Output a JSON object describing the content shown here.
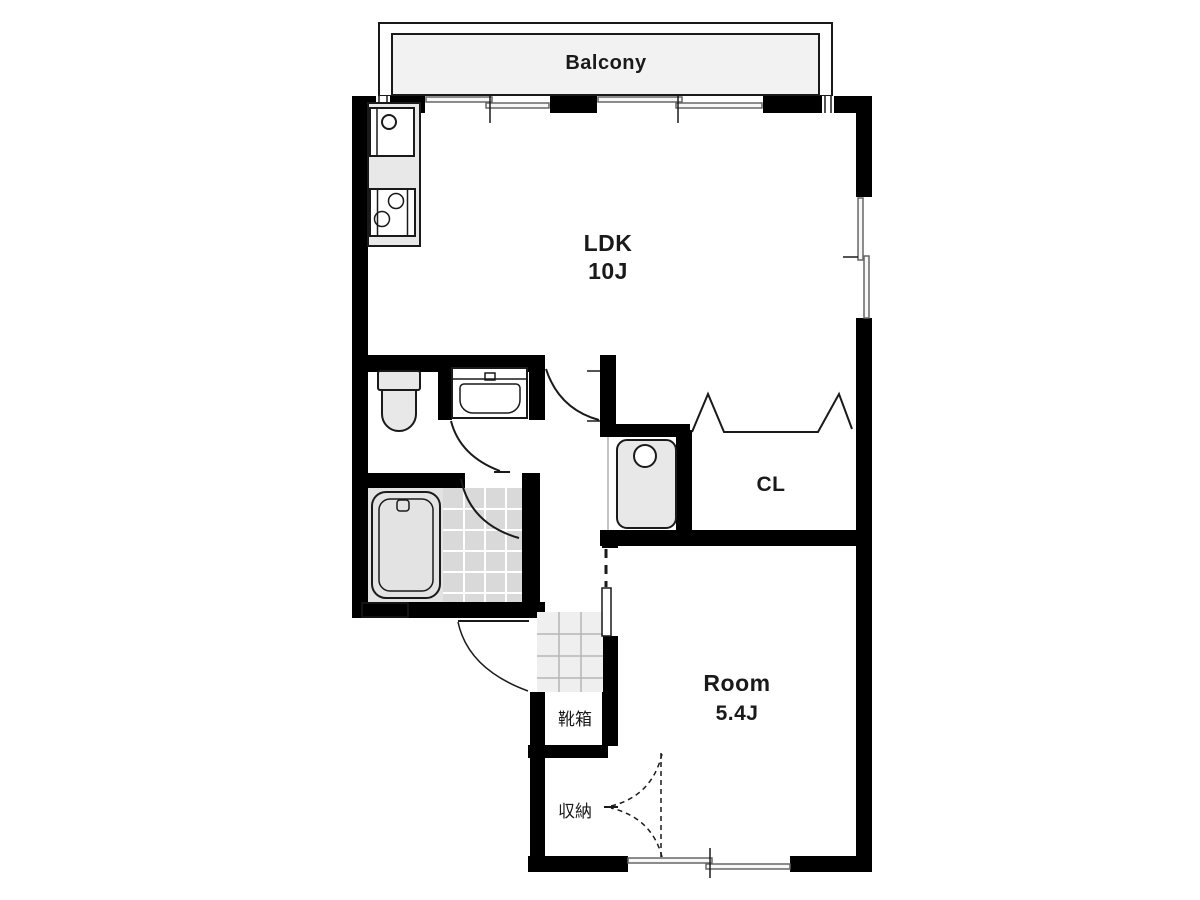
{
  "plan": {
    "labels": {
      "balcony": "Balcony",
      "ldk": "LDK",
      "ldk_size": "10J",
      "closet": "CL",
      "room": "Room",
      "room_size": "5.4J",
      "shoe_cabinet": "靴箱",
      "storage": "収納"
    },
    "fixtures": [
      "kitchen-sink",
      "gas-stove",
      "toilet",
      "washbasin-vanity",
      "bathtub",
      "washing-machine-pan",
      "shoe-cabinet",
      "storage-closet"
    ],
    "colors": {
      "wall": "#000000",
      "line": "#1a1a1a",
      "fixture_fill": "#e8e8e8",
      "bathroom_floor": "#e3e3e3",
      "tile_fill": "#d9d9d9",
      "genkan_tile_fill": "#efefef",
      "balcony_fill": "#f2f2f2",
      "background": "#ffffff"
    }
  }
}
